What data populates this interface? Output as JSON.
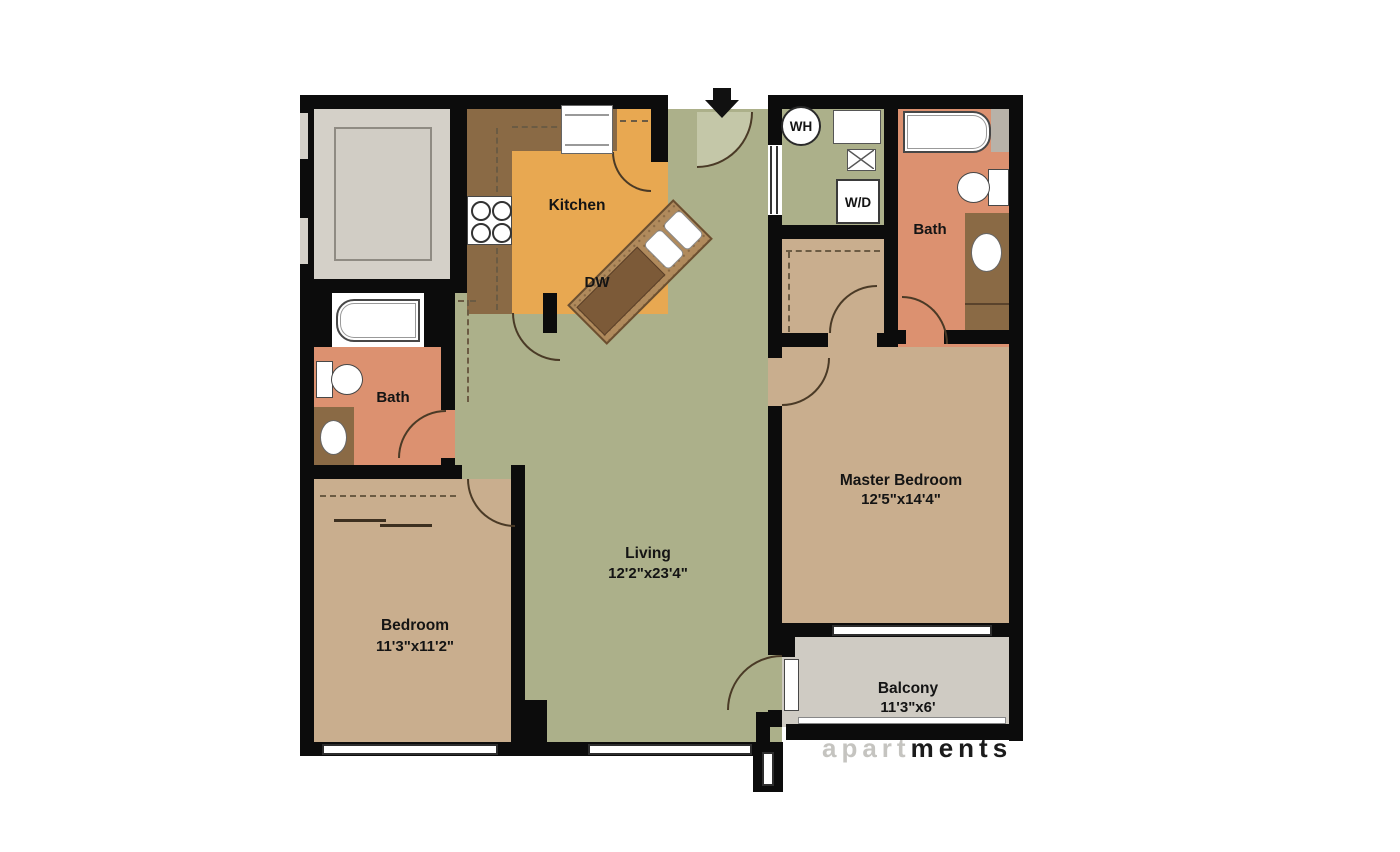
{
  "plan": {
    "type": "apartment floor plan",
    "rooms": {
      "kitchen": {
        "name": "Kitchen"
      },
      "living": {
        "name": "Living",
        "dims": "12'2\"x23'4\""
      },
      "master_bedroom": {
        "name": "Master Bedroom",
        "dims": "12'5\"x14'4\""
      },
      "bedroom": {
        "name": "Bedroom",
        "dims": "11'3\"x11'2\""
      },
      "master_bath": {
        "name": "Bath"
      },
      "second_bath": {
        "name": "Bath"
      },
      "balcony": {
        "name": "Balcony",
        "dims": "11'3\"x6'"
      }
    },
    "appliances": {
      "dishwasher": "DW",
      "water_heater": "WH",
      "washer_dryer": "W/D"
    },
    "watermark": {
      "left_part": "apart",
      "right_part": "ments"
    },
    "colors": {
      "living_green": "#ACB08A",
      "entry_swing_green": "#C4C7A8",
      "kitchen_orange": "#E8A851",
      "counter_brown": "#8A6A45",
      "island_brown": "#B08A5C",
      "island_dark": "#7C5A38",
      "room_tan": "#C9AE8E",
      "bath_salmon": "#DC9170",
      "patio_gray": "#D4D0C8",
      "balcony_gray": "#CFCBC3",
      "wall_black": "#0C0C0C"
    }
  }
}
